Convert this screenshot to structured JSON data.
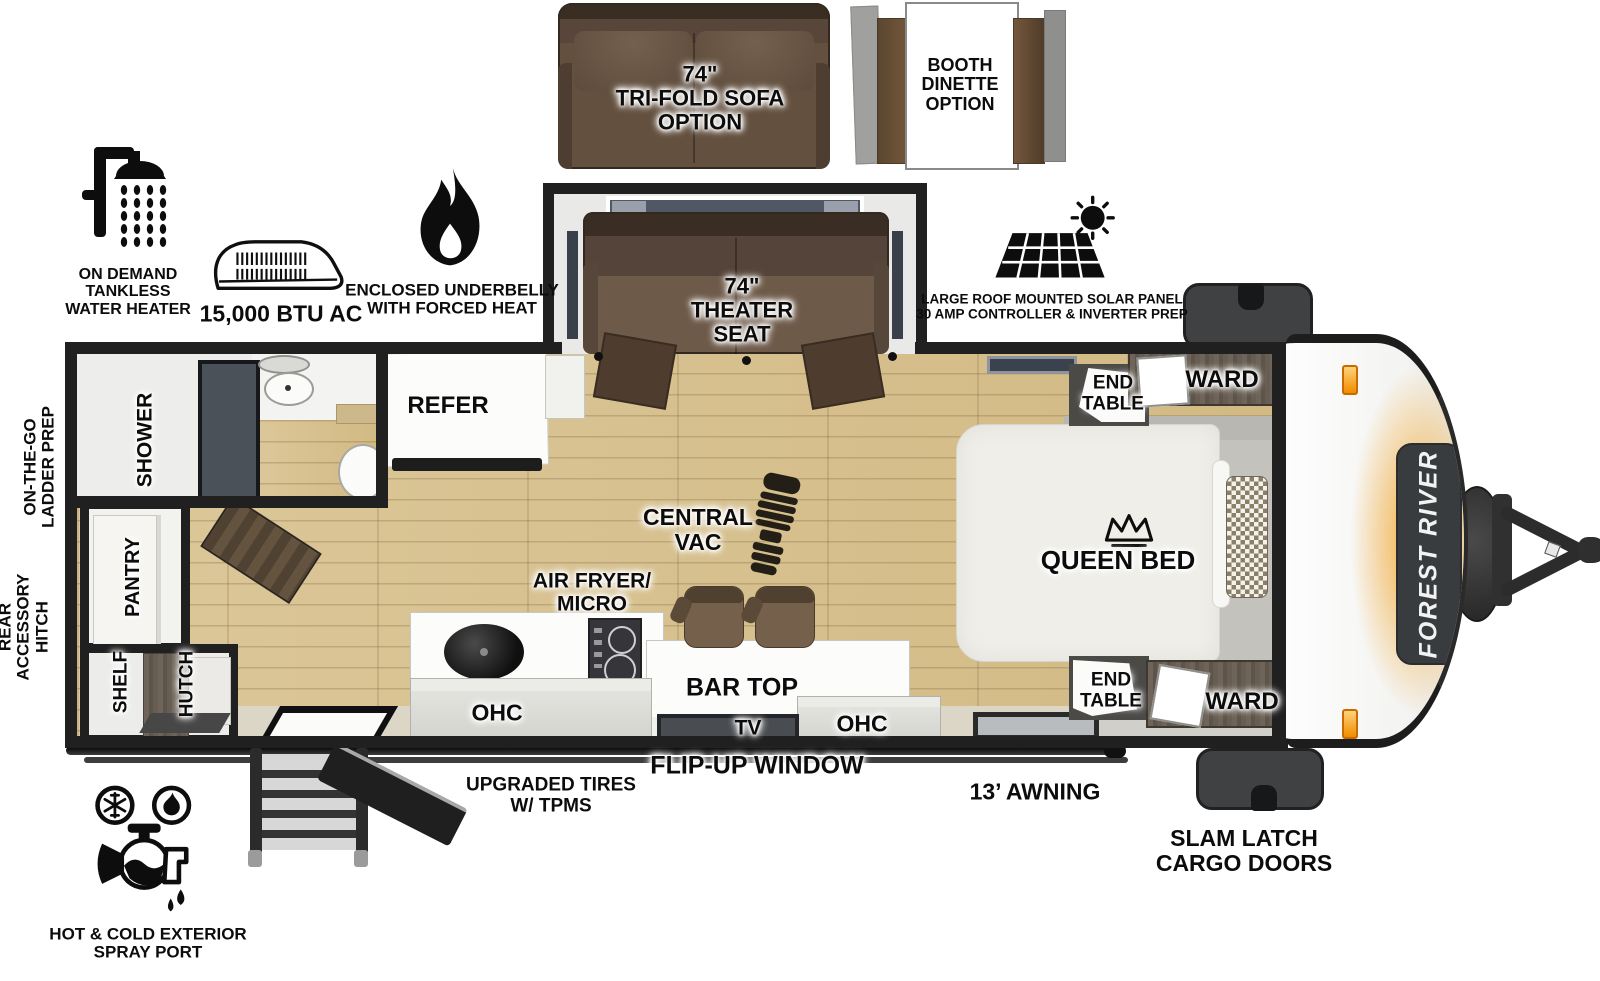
{
  "brand": {
    "name": "FOREST RIVER"
  },
  "options": {
    "sofa": "74\"\nTRI-FOLD SOFA\nOPTION",
    "dinette": "BOOTH\nDINETTE\nOPTION"
  },
  "features": {
    "water_heater": "ON DEMAND\nTANKLESS\nWATER HEATER",
    "ac": "15,000 BTU AC",
    "underbelly": "ENCLOSED UNDERBELLY\nWITH FORCED HEAT",
    "solar": "LARGE ROOF MOUNTED SOLAR PANEL\n30 AMP CONTROLLER & INVERTER PREP",
    "spray_port": "HOT & COLD EXTERIOR\nSPRAY PORT",
    "tires": "UPGRADED TIRES\nW/ TPMS"
  },
  "rooms": {
    "shower": "SHOWER",
    "refer": "REFER",
    "theater_seat": "74\"\nTHEATER\nSEAT",
    "central_vac": "CENTRAL\nVAC",
    "air_fryer": "AIR FRYER/\nMICRO",
    "bar_top": "BAR TOP",
    "queen_bed": "QUEEN BED",
    "end_table_top": "END\nTABLE",
    "end_table_bottom": "END\nTABLE",
    "ward_top": "WARD",
    "ward_bottom": "WARD",
    "pantry": "PANTRY",
    "shelf": "SHELF",
    "hutch": "HUTCH",
    "ohc_kitchen": "OHC",
    "ohc_bar": "OHC",
    "tv": "TV"
  },
  "exterior": {
    "ladder_prep": "ON-THE-GO\nLADDER PREP",
    "rear_hitch": "REAR\nACCESSORY\nHITCH",
    "flip_up_window": "FLIP-UP WINDOW",
    "awning": "13’ AWNING",
    "cargo_doors": "SLAM LATCH\nCARGO DOORS"
  },
  "icons": {
    "shower": "shower-icon",
    "ac": "ac-unit-icon",
    "flame": "flame-icon",
    "solar": "solar-panel-icon",
    "boot": "boot-print-icon",
    "crown": "crown-icon",
    "spray": "spray-port-icon"
  },
  "colors": {
    "wall": "#202020",
    "floor_wood": "#d8c291",
    "sofa_brown": "#63503f",
    "cabinet_wood": "#6e6459",
    "accent_orange": "#f2a43a",
    "badge_dark": "#393c3e"
  }
}
